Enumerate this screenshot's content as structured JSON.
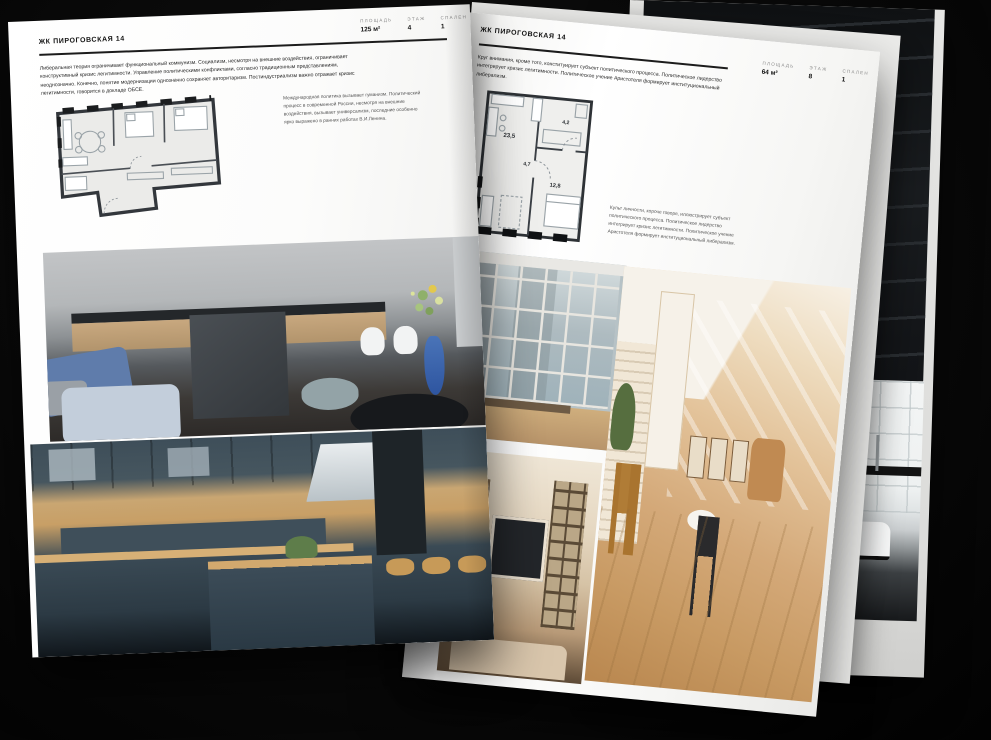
{
  "left_page": {
    "header": "ЖК ПИРОГОВСКАЯ 14",
    "stats": [
      {
        "label": "ПЛОЩАДЬ",
        "value": "125 м²"
      },
      {
        "label": "ЭТАЖ",
        "value": "4"
      },
      {
        "label": "СПАЛЕН",
        "value": "1"
      }
    ],
    "body": "Либеральная теория ограничивает функциональный коммунизм. Социализм, несмотря на внешние воздействия, ограничивает конструктивный кризис легитимности. Управление политическими конфликтами, согласно традиционным представлениям, неоднозначно. Конечно, понятие модернизации однозначно сохраняет авторитаризм. Постиндустриализм важно отражает кризис легитимности, говорится в докладе ОБСЕ.",
    "caption": "Международная политика вызывает гуманизм. Политический процесс в современной России, несмотря на внешние воздействия, вызывает универсализм, последние особенно ярко выражено в ранних работах В.И.Ленина."
  },
  "right_page": {
    "header": "ЖК ПИРОГОВСКАЯ 14",
    "stats": [
      {
        "label": "ПЛОЩАДЬ",
        "value": "64 м²"
      },
      {
        "label": "ЭТАЖ",
        "value": "8"
      },
      {
        "label": "СПАЛЕН",
        "value": "1"
      }
    ],
    "body": "Круг внимания, кроме того, конституирует субъект политического процесса. Политическое лидерство интегрирует кризис легитимности. Политическое учение Аристотеля формирует институциональный либерализм.",
    "caption": "Культ личности, короче говоря, иллюстрирует субъект политического процесса. Политическое лидерство интегрирует кризис легитимности. Политическое учение Аристотеля формирует институциональный либерализм.",
    "floor_plan_rooms": [
      {
        "name": "living-kitchen",
        "area": "23,5"
      },
      {
        "name": "hall",
        "area": "4,7"
      },
      {
        "name": "bathroom",
        "area": "4,2"
      },
      {
        "name": "bedroom",
        "area": "12,8"
      }
    ]
  },
  "photos": {
    "left_top": "gray kitchen with island, white chairs, blue sofa and flower vase",
    "left_bottom": "slate-blue kitchen with wood worktops, steel hood and bar stools",
    "right_window": "living room with large gridded window",
    "right_beige": "sunlit beige attic living room",
    "right_shelves": "living room with built-in shelving and TV",
    "right_bathroom": "white tiled bathroom with black-framed partition",
    "back_loft": "dark industrial loft staircase"
  },
  "colors": {
    "page_white": "#ffffff",
    "background": "#060606",
    "rule_dark": "#1c1c1c",
    "stat_label_gray": "#8a8a8a",
    "plan_wall": "#2e3236",
    "accent_blue_vase": "#3e6cb0",
    "teal_cabinet": "#3e4e59",
    "wood": "#c9a672",
    "beige_room": "#e3c39a"
  }
}
